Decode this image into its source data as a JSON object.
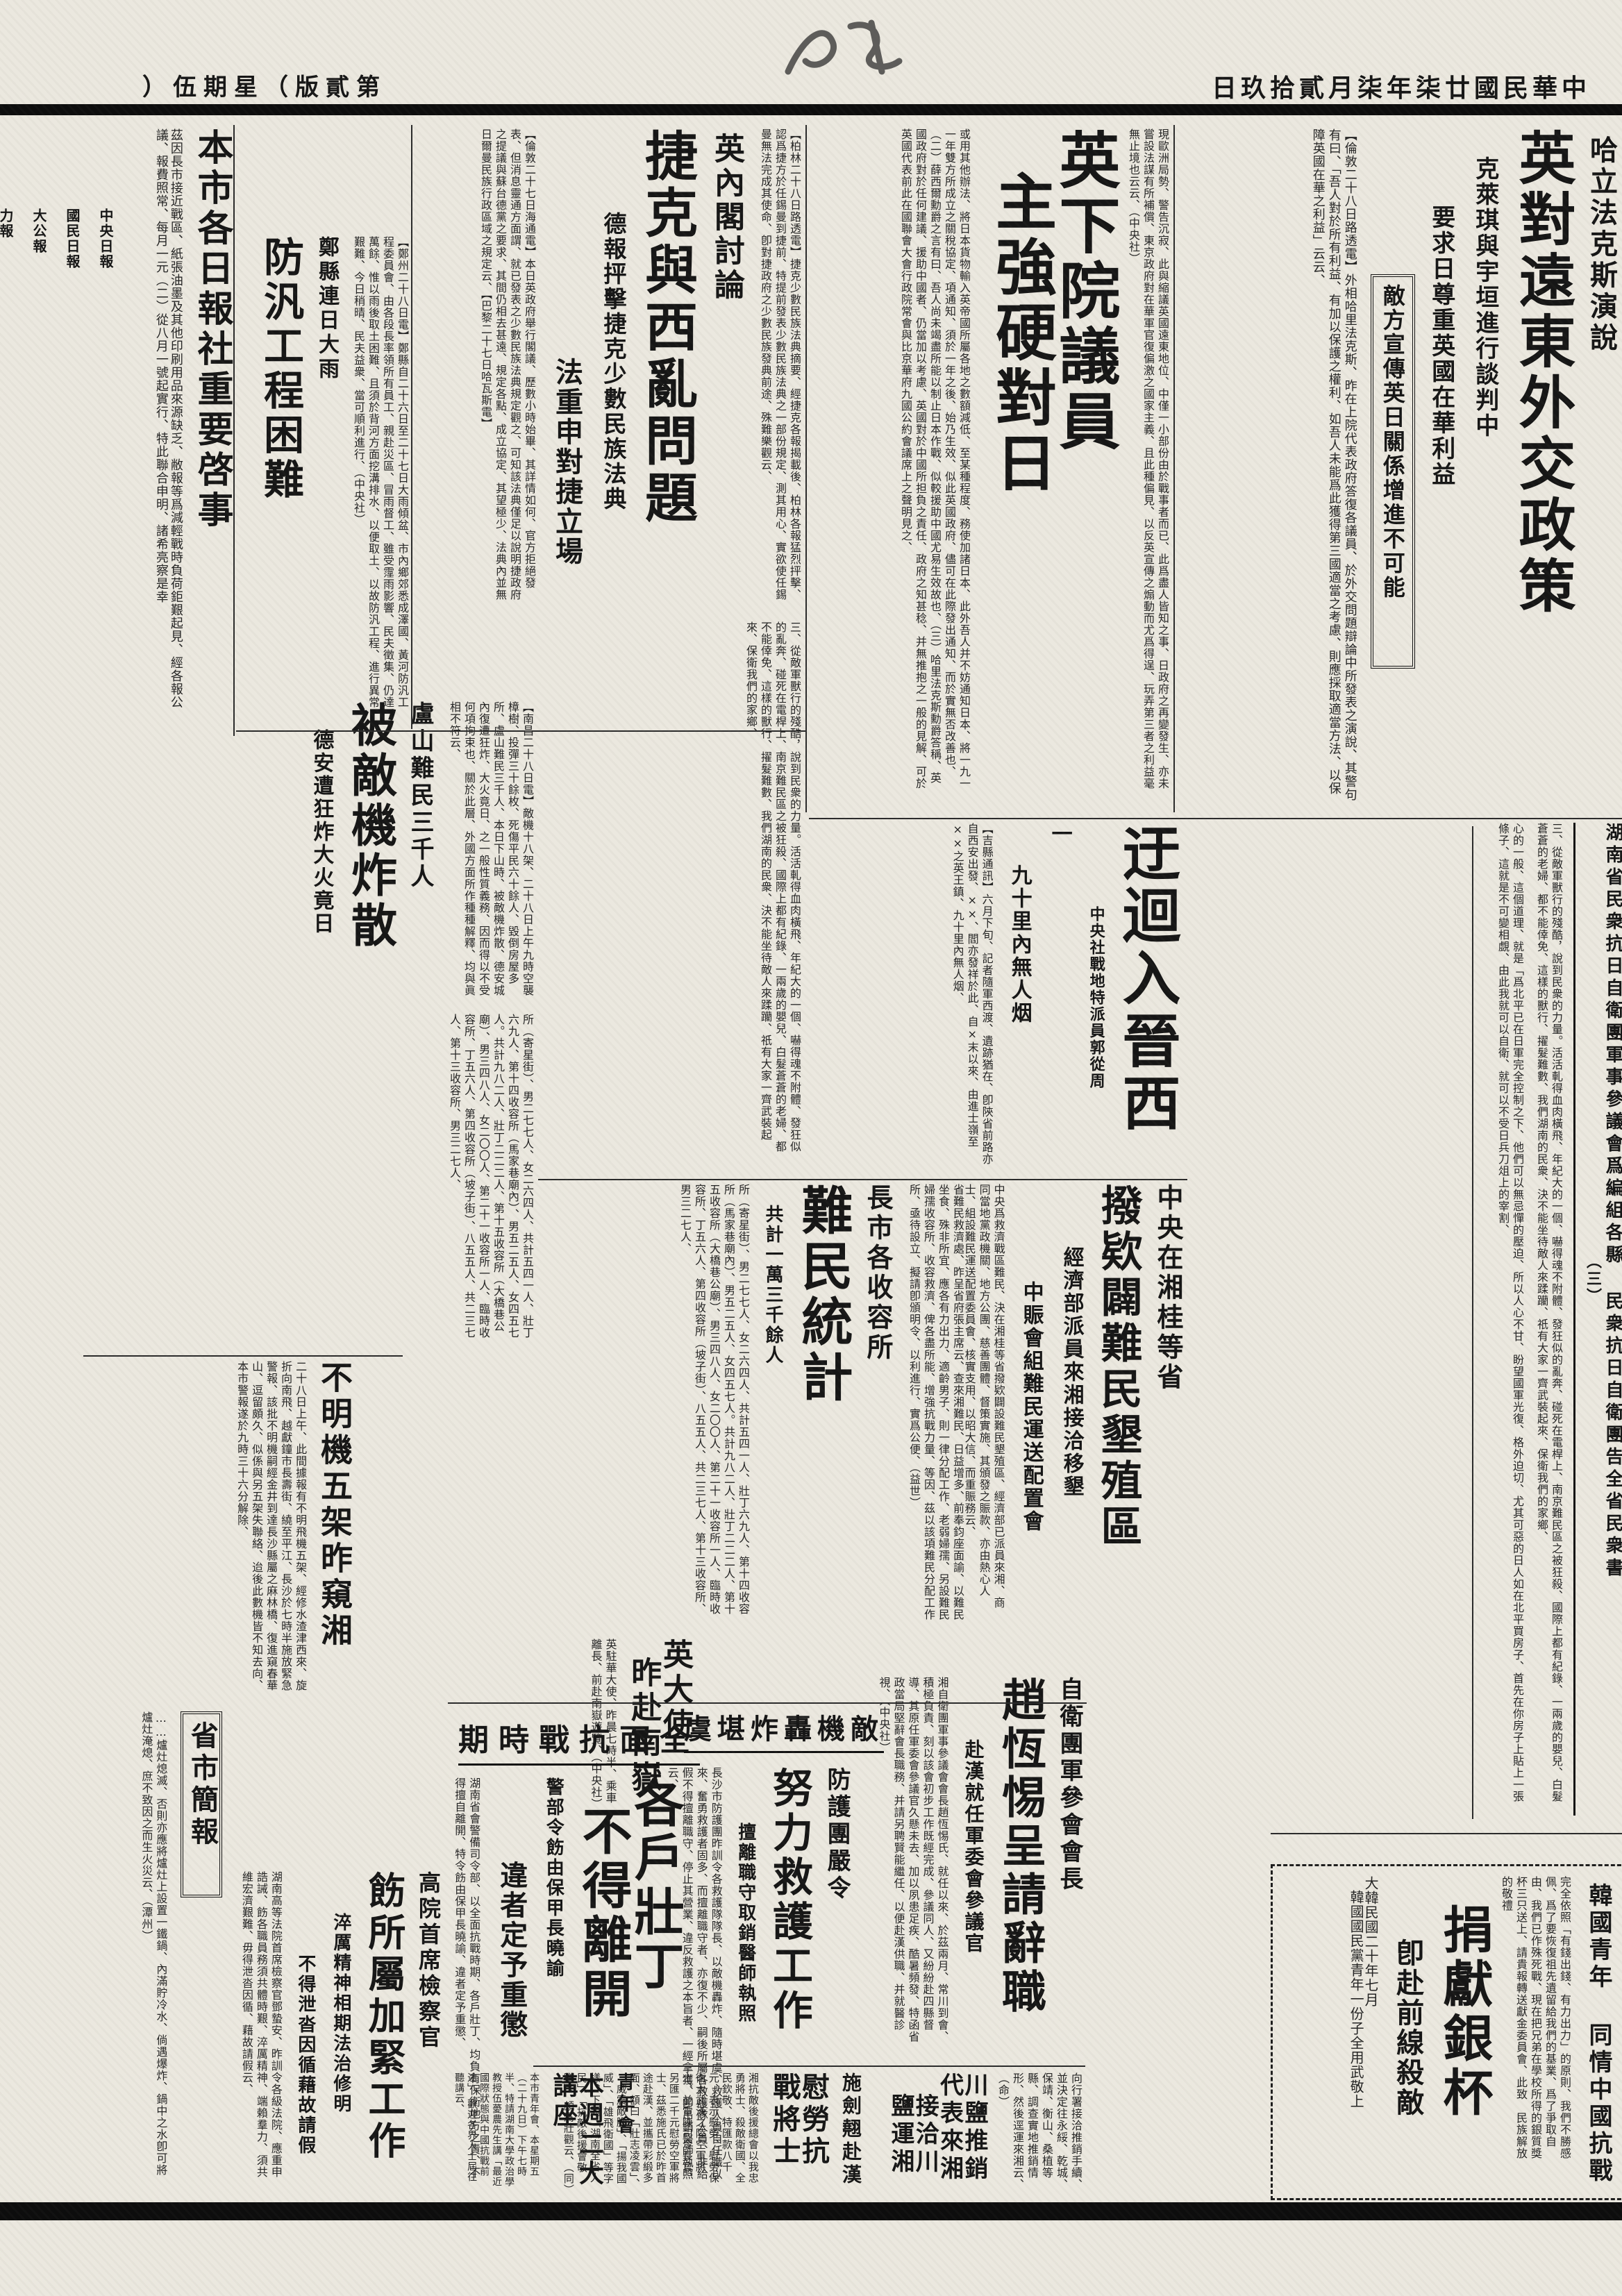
{
  "masthead": {
    "date_line": "中華民國廿柒年柒月貳拾玖日",
    "edition_label": "第貳版（星期伍）"
  },
  "articles": {
    "halifax": {
      "kicker": "哈立法克斯演說",
      "headline": "英對遠東外交政策",
      "sub1": "克萊琪與宇垣進行談判中",
      "sub2": "要求日尊重英國在華利益",
      "boxed": "敵方宣傳英日關係增進不可能",
      "body": "【倫敦二十八日路透電】外相哈里法克斯、昨在上院代表政府答復各議員、於外交問題辯論中所發表之演說、其警句有曰、「吾人對於所有利益、有加以保護之權利、如吾人未能爲此獲得第三國適當之考慮、則應採取適當方法、以保障英國在華之利益」云云、"
    },
    "commons": {
      "headline_l1": "英下院議員",
      "headline_l2": "主強硬對日",
      "body": "現歐洲局勢、警告沉寂、此與縮議英國遠東地位、中僅一小部份由於戰事者而已、此爲盡人皆知之事、日政府之再變發生、亦未嘗設法謀有所補償、東京政府對在華軍官復偏激之國家主義、且此種偏見、以反英宣傳之煽動而尤爲得逞、玩弄第三者之利益毫無止境也云云、（中央社）",
      "body2": "或用其他辦法、將日本貨物輸入英帝國所屬各地之數額減低、至某種程度、務使加諸日本、此外吾人并不妨通知日本、將一九一一年雙方所成立之關稅協定、項通知、須於一年之後、始乃生效、似此英國政府、儘可在此際發出通知、而於實無否改善也、（二）薛西爾勳爵之言有曰、吾人尚未竭盡所能以制止日本作戰、似較援助中國尤易生效故也、（三）哈里法克斯勳爵答稱、英國政府對於任何建議、援助中國者、仍當加以考慮、英國對於中國所担負之責任、政府之知甚稔、并無推抱之一般的見解、可於英國代表前此在國聯會大會行政院常會與比京華府九國公約會議席上之聲明見之、"
    },
    "czech": {
      "kicker": "英內閣討論",
      "headline": "捷克與西亂問題",
      "sub1": "德報抨擊捷克少數民族法典",
      "sub2": "法重申對捷立場",
      "body": "【倫敦二十七日海通電】本日英政府舉行閣議、歷數小時始畢、其詳情如何、官方拒絕發表、但消息靈通方面謂、就已發表之少數民族法典規定觀之、可知該法典僅足以說明捷政府之提議與蘇台德黨之要求、其間仍相去甚遠、規定各點、成立協定、其望極少、法典內並無日爾曼民族行政區域之規定云、【巴黎二十七日哈瓦斯電】",
      "body2": "【柏林二十八日路透電】捷克少數民族法典摘要、經捷克各報揭載後、柏林各報猛烈抨擊、認爲捷方於任錫曼到捷前、特提前發表少數民族法典之一部份規定、測其用心、實欲使任錫曼無法完成其使命、卽對捷政府之少數民族發典前途、殊難樂觀云、"
    },
    "press_notice": {
      "headline": "本市各日報社重要啓事",
      "body": "茲因長市接近戰區、紙張油墨及其他印刷用品來源缺乏、敝報等爲減輕戰時負荷鉅艱起見、經各報公議、報費照常、每月一元（二）從八月一號起實行、特此聯合申明、諸希亮察是幸",
      "papers": [
        "中央日報",
        "國民日報",
        "大公報",
        "力報",
        "民國日報",
        "全民日報",
        "市民日報",
        "商報",
        "晨報",
        "衡報",
        "生報",
        "正中日報同啓"
      ]
    },
    "zhengxian_flood": {
      "kicker": "鄭縣連日大雨",
      "headline": "防汎工程困難",
      "body": "【鄭州二十八日電】鄭縣自二十六日至二十七日大雨傾盆、市內鄉郊悉成澤國、黃河防汎工程委員會、由各段長率領所有員工、親赴災區、冒雨督工、雖受霪雨影響、民夫徵集、仍達萬餘、惟以雨後取土困難、且須於背河方面挖溝排水、以便取土、以故防汎工程、進行異常艱難、今日稍晴、民夫益衆、當可順利進行、（中央社）"
    },
    "lushan_refugees": {
      "kicker": "盧山難民三千人",
      "headline": "被敵機炸散",
      "sub": "德安遭狂炸大火竟日",
      "body": "【南昌二十八日電】敵機十八架、二十八日上午九時空襲樟樹、投彈三十餘枚、死傷平民六十餘人、毀倒房屋多所、盧山難民三千人、本日下山時、被敵機炸散、德安城內復遭狂炸、大火竟日、之一般性質義務、因而得以不受何項拘束也、關於此層、外國方面所作種種解釋、均與眞相不符云、"
    },
    "hunan_letter": {
      "title_l1": "湖南省民衆抗日自衛團軍事參議會爲編組各縣",
      "title_l2": "民衆抗日自衛團告全省民衆書",
      "part_no": "（三）",
      "body": "三、從敵軍獸行的殘酷，說到民衆的力量。活活軋得血肉橫飛、年紀大的一個、嚇得魂不附體、發狂似的亂奔、碰死在電桿上、南京難民區之被狂殺、國際上都有紀錄、一兩歲的嬰兒、白髮蒼蒼的老婦、都不能倖免、這樣的獸行、擢髮難數、我們湖南的民衆、決不能坐待敵人來蹂躪、祇有大家一齊武裝起來、保衛我們的家鄉、",
      "body2": "心的一般、這個道理、就是「爲北平已在日軍完全控制之下、他們可以無忌憚的壓迫、所以人心不甘、盼望國軍光復、格外迫切、尤其可惡的日人如在北平買房子、首先在你房子上貼上一張條子、這就是不可變相覷、由此我就可以自衛、就可以不受日兵刀俎上的宰割、"
    },
    "jinxi_detour": {
      "headline": "迂迴入晉西",
      "byline": "中央社戰地特派員郭從周",
      "section_no": "一",
      "sub": "九十里內無人烟",
      "body": "【吉縣通訊】六月下旬、記者隨軍西渡、遺跡猶在、卽陝省前路亦自西安出發、××、閻亦發祥於此、自×末以來、由進士嶺至××之英王鎮、九十里內無人烟、"
    },
    "reclamation_fund": {
      "kicker": "中央在湘桂等省",
      "headline": "撥欵闢難民墾殖區",
      "sub1": "經濟部派員來湘接洽移墾",
      "sub2": "中賑會組難民運送配置會",
      "body": "中央爲救濟戰區難民、決在湘桂等省撥欵闢設難民墾殖區、經濟部已派員來湘、商同當地黨政機關、地方公團、慈善團體、督策實施、其頒發之賑款、亦由熱心人士、組設難民運送配置委員會、核實支用、以昭大信、而重賑務云、"
    },
    "refugee_stats": {
      "kicker": "長市各收容所",
      "headline": "難民統計",
      "sub": "共計一萬三千餘人",
      "body": "省難民救濟處、昨呈省府張主席云、查來湘難民、日益增多、前奉鈞座面諭、以難民坐食、殊非所宜、應各有力出力、適齡男子、則一律分配工作、老弱婦孺、另設難民婦孺收容所、收容救濟、俾各盡所能、增強抗戰力量、等因、茲以該項難民分配工作所、亟待設立、擬請卽頒明令、以利進行、實爲公便、（益世）",
      "body2": "所（寄星街）、男二七七人、女二六四人、共計五四一人、壯丁六九人、第十四收容所（馬家巷廟內）、男五二五人、女四五七人。共計九八二人、壯丁二二二人、第十五收容所（大橋巷公廟）、男三四八人、女二〇〇人、第二十一收容所一人、臨時收容所、丁五六人、第四收容所（坡子街）、八五五人、共二三七人、第十三收容所、男三二七人、"
    },
    "uk_ambassador": {
      "headline_l1": "英大使",
      "headline_l2": "昨赴南嶽",
      "body": "英駐華大使、昨晨七時半、乘車離長、前赴南嶽遊覽、（中央社）"
    },
    "conscripts": {
      "strip": "全面抗戰時期",
      "headline_l1": "各戶壯丁",
      "headline_l2": "不得離開",
      "sub1": "警部令飭由保甲長曉諭",
      "sub2": "違者定予重懲",
      "body": "湖南省會警備司令部、以全面抗戰時期、各戶壯丁、均負有保衛地方之責、不得擅自離開、特令飭由保甲長曉諭、違者定予重懲、"
    },
    "unknown_planes": {
      "headline": "不明機五架昨窺湘",
      "body": "二十八日上午、此間據報有不明飛機五架、經修水渣津西來、旋折向南飛、越獻鐘市長壽街、繞至平江、長沙於七時半施放緊急警報、該批不明機嗣經金井到達長沙縣屬之麻林橋、復進窺春華山、逗留頗久、似係與另五架失聯絡、迨後此數機皆不知去向、本市警報遂於九時三十六分解除、"
    },
    "provincial_briefs": {
      "title": "省市簡報",
      "body": "……爐灶熄滅、否則亦應將爐灶上設置一鐵鍋、內滿貯冷水、倘遇爆炸、鍋中之水卽可將爐灶淹熄、庶不致因之而生火災云、（潭州）"
    },
    "air_defense": {
      "strip": "敵機轟炸堪虞",
      "kicker": "防護團嚴令",
      "headline": "努力救護工作",
      "sub": "擅離職守取銷醫師執照",
      "body": "長沙市防護團昨訓令各救護隊隊長、以敵機轟炸、隨時堪虞、救護人員自任職以來、奮勇救護者固多、而擅離職守者、亦復不少、嗣後所屬各救護隊人員、非給假不得擅離職守、停止其營業、違反救護之本旨者、一經拿獲、卽吊銷醫師執照云、",
      "body2": "勸導市民預防引起火災"
    },
    "zhao_hengti": {
      "kicker": "自衛團軍參會會長",
      "headline": "趙恆惕呈請辭職",
      "sub": "赴漢就任軍委會參議官",
      "body": "湘自衛團軍事參議會會長趙恆惕氏、就任以來、於茲兩月、常川到會、積極負責、刻以該會初步工作既經完成、參議同人、又紛紛赴四縣督導、其原任軍委會參議官久懸未去、加以夙患足疾、酷暑頻發、特函省政當局堅辭會長職務、并請另聘賢能繼任、以便赴漢供職、并就醫診視、（中央社）"
    },
    "korean_youth": {
      "kicker_l1": "韓國青年",
      "kicker_l2": "同情中國抗戰",
      "headline": "捐獻銀杯",
      "sub": "卽赴前線殺敵",
      "body": "完全依照「有錢出錢、有力出力」的原則、我們不勝感佩、爲了要恢復祖先遺留給我們的基業、爲了爭取自由、我們已作殊死戰、現在把兄弟在學校所得的銀質獎杯三只送上、請貴報轉送獻金委員會、此致　民族解放的敬禮",
      "sig1": "大韓民國二十年七月",
      "sig2": "韓國國民黨青年一份子全用武敬上"
    },
    "sichuan_salt": {
      "headline_l1": "川鹽推銷代表來湘",
      "headline_l2": "接洽川鹽運湘",
      "body": "向行署接洽推銷手續、並決定往永綏、乾城、保靖、衡山、桑植等縣、調查實地推銷情形、然後逕運來湘云、（命）"
    },
    "shi_jianqiao": {
      "kicker": "施劍翹赴漢",
      "headline": "慰勞抗戰將士",
      "body": "湘抗敵後援總會以我忠勇將士、殺敵衛國、全民欽敬、特匯款八千元、表示慰勞、慰勞保衛大武漢之陸空軍將士、並電陳司令長官、另匯二千元慰勞空軍將士、茲悉施氏已於昨首途赴漢、並攜帶彩緞多面、額曰「壯志凌雲」、「威震敵膽」、「揚我國威」、「雄飛衛國」等字樣、下題「湖南全省人民」、「抗敵後援會敬贈」、頗爲壯觀云、（同）"
    },
    "ymca_lecture": {
      "kicker": "青年會",
      "headline": "本週二大講座",
      "body": "本市青年會、本星期五（二十九日）下午七時半、特請湖南大學政治學教授伍薆農先生講「最近國際狀態與中國抗戰前途」、歡迎各界人士屆往聽講云、"
    },
    "high_court": {
      "kicker": "高院首席檢察官",
      "headline": "飭所屬加緊工作",
      "sub1": "淬厲精神相期法治修明",
      "sub2": "不得泄沓因循藉故請假",
      "body": "湖南高等法院首席檢察官鄧蟄安、昨訓令各級法院、應重申誥誡、飭各職員務須共體時艱、淬厲精神、端賴羣力、須共維宏濟艱難、毋得泄沓因循、藉故請假云、"
    }
  }
}
